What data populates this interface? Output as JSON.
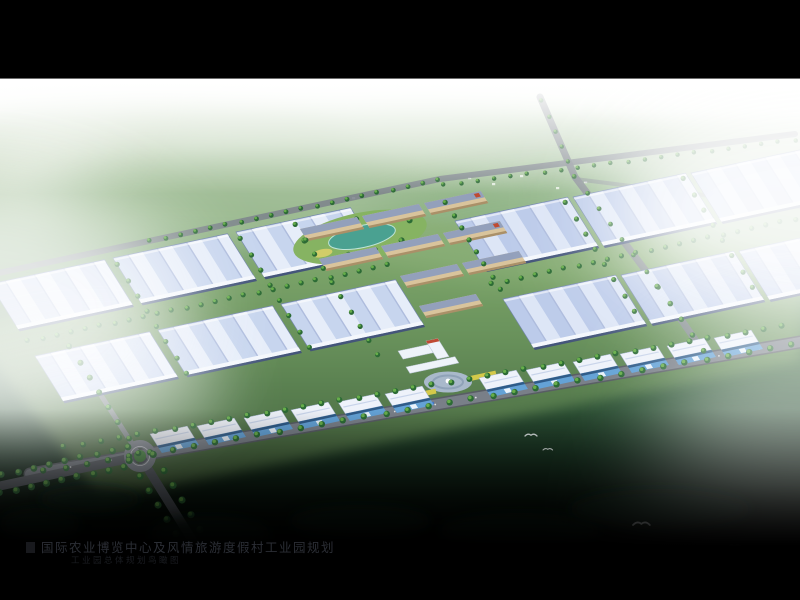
{
  "window": {
    "background": "#000000",
    "divider_line": "#6e6e6e"
  },
  "scene": {
    "kind": "aerial architectural rendering",
    "subject": "industrial park master plan bird's-eye view with blue-roofed warehouse halls, central tan office campus, entrance plaza, tree-lined roads, roundabout and misty countryside",
    "caption_line1": "国际农业博览中心及风情旅游度假村工业园规划",
    "caption_line2": "工业园总体规划鸟瞰图",
    "counts": {
      "left_warehouses": 6,
      "right_warehouses": 6,
      "campus_buildings": 9,
      "workshops": 12,
      "birds": 4,
      "road_dashes": 18,
      "vehicles": 5
    }
  },
  "colors": {
    "letterbox": "#000000",
    "sky_top": "#f4faf2",
    "far_green": "#b9cdae",
    "mid_green": "#6f9a68",
    "park_ground": "#86ab67",
    "roof_base": "#c7d5ee",
    "roof_stripe": "#e6edf9",
    "roof_base_right": "#bccbea",
    "roof_stripe_right": "#dde6f6",
    "roof_edge": "#7386ad",
    "roof_eave": "#f4f7fc",
    "roof_shadow": "#44557a",
    "campus_wall": "#d9c49c",
    "campus_roof": "#93a0bb",
    "campus_shadow": "#aa9068",
    "campus_accent_red": "#bf4a32",
    "pond": "#4aa191",
    "pond_edge": "#bfe3d8",
    "road": "#7d838c",
    "road_dark": "#585d64",
    "road_line": "#e9eaec",
    "tree_dark": "#2c6b35",
    "tree_light": "#67ae4a",
    "workshop_roof": "#eef2fa",
    "workshop_front": "#64a2d6",
    "workshop_band": "#2f5b88",
    "plaza": "#a9b9cb",
    "plaza_ring": "#8fa2b8",
    "gate_white": "#eef3f9",
    "flowerbed": "#d4c94a",
    "bird": "#f5f8fa",
    "mist": "#ffffff",
    "foreground_dark": "#0f2416",
    "caption_text": "#2b2e35",
    "caption_subtext": "#1a1c21"
  }
}
